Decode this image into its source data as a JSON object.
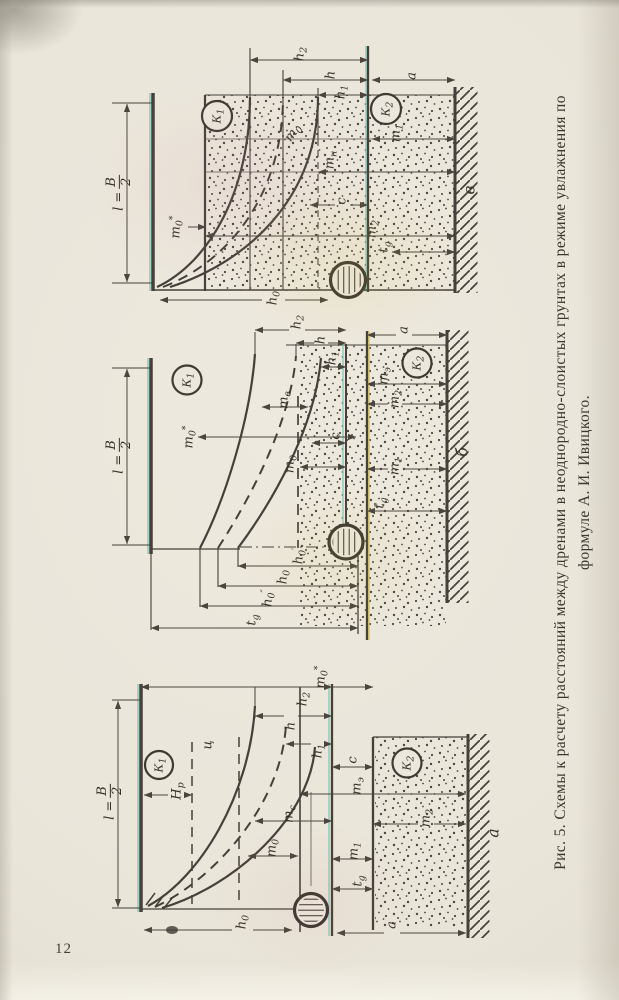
{
  "page": {
    "number": "12"
  },
  "caption": {
    "line1": "Рис. 5. Схемы к расчету расстояний между дренами в неоднородно-слоистых грунтах в режиме увлажнения по",
    "line2": "формуле А. И. Ивицкого."
  },
  "colors": {
    "paper": "#e9e5d9",
    "ink": "#45413a",
    "accent_cyan": "#74c2b6",
    "accent_yellow": "#d8c44a"
  },
  "diagrams": [
    {
      "sub_label": "в",
      "labels": {
        "leq": {
          "eq": "l =",
          "num": "B",
          "den": "2"
        },
        "k1": {
          "b": "К",
          "s": "1"
        },
        "k2": {
          "b": "К",
          "s": "2"
        },
        "h2": {
          "b": "h",
          "s": "2"
        },
        "h": {
          "b": "h"
        },
        "h1": {
          "b": "h",
          "s": "1"
        },
        "a": {
          "b": "a"
        },
        "m0s": {
          "b": "m",
          "s": "0",
          "p": "*"
        },
        "m0": {
          "b": "m",
          "s": "0"
        },
        "m1": {
          "b": "m",
          "s": "1"
        },
        "mn": {
          "b": "m",
          "s": "н"
        },
        "c": {
          "b": "c"
        },
        "m2": {
          "b": "m",
          "s": "2"
        },
        "tg": {
          "b": "t",
          "s": "g"
        },
        "h0": {
          "b": "h",
          "s": "0"
        }
      }
    },
    {
      "sub_label": "б",
      "labels": {
        "leq": {
          "eq": "l =",
          "num": "B",
          "den": "2"
        },
        "k1": {
          "b": "К",
          "s": "1"
        },
        "k2": {
          "b": "К",
          "s": "2"
        },
        "h2": {
          "b": "h",
          "s": "2"
        },
        "h": {
          "b": "h"
        },
        "h1": {
          "b": "h",
          "s": "1"
        },
        "a": {
          "b": "a"
        },
        "m0s": {
          "b": "m",
          "s": "0",
          "p": "*"
        },
        "mv": {
          "b": "m",
          "s": "в"
        },
        "me": {
          "b": "m",
          "s": "э"
        },
        "m2": {
          "b": "m",
          "s": "2"
        },
        "c": {
          "b": "c"
        },
        "m0": {
          "b": "m",
          "s": "0"
        },
        "m1": {
          "b": "m",
          "s": "1"
        },
        "tg": {
          "b": "t",
          "s": "g"
        },
        "h0p": {
          "b": "h",
          "s": "0",
          "p": "′"
        },
        "h0": {
          "b": "h",
          "s": "0"
        },
        "h0pp": {
          "b": "h",
          "s": "0",
          "p": "″"
        }
      }
    },
    {
      "sub_label": "а",
      "labels": {
        "leq": {
          "eq": "l =",
          "num": "B",
          "den": "2"
        },
        "k1": {
          "b": "К",
          "s": "1"
        },
        "k2": {
          "b": "К",
          "s": "2"
        },
        "ts": {
          "b": "ц"
        },
        "hp": {
          "b": "H",
          "s": "p"
        },
        "h2": {
          "b": "h",
          "s": "2"
        },
        "m0s": {
          "b": "m",
          "s": "0",
          "p": "*"
        },
        "h": {
          "b": "h"
        },
        "h1": {
          "b": "h",
          "s": "1"
        },
        "c": {
          "b": "c"
        },
        "me": {
          "b": "m",
          "s": "э"
        },
        "mc": {
          "b": "m",
          "s": "с"
        },
        "m0": {
          "b": "m",
          "s": "0"
        },
        "m2": {
          "b": "m",
          "s": "2"
        },
        "m1": {
          "b": "m",
          "s": "1"
        },
        "tg": {
          "b": "t",
          "s": "g"
        },
        "h0": {
          "b": "h",
          "s": "0"
        },
        "a": {
          "b": "a"
        }
      }
    }
  ]
}
